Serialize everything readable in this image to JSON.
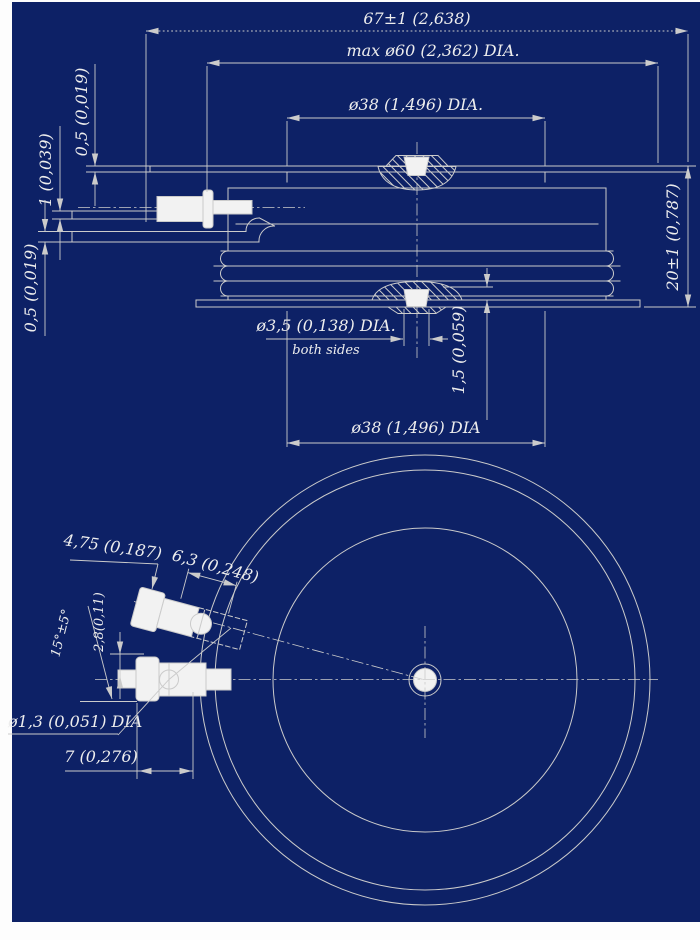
{
  "colors": {
    "background": "#0d2166",
    "line": "#cbcbcb",
    "text": "#ededed",
    "shape_fill": "#f2f2f2"
  },
  "side_view": {
    "overall_width": "67±1 (2,638)",
    "max_body_dia": "max ø60 (2,362) DIA.",
    "top_pole_dia": "ø38 (1,496) DIA.",
    "flange_thickness": "0,5 (0,019)",
    "gate_lead_thickness": "1 (0,039)",
    "cathode_lead_thickness": "0,5 (0,019)",
    "height": "20±1 (0,787)",
    "center_hole_dia": "ø3,5 (0,138) DIA.",
    "center_hole_note": "both sides",
    "pole_boss_height": "1,5 (0,059)",
    "bottom_pole_dia": "ø38 (1,496) DIA"
  },
  "bottom_view": {
    "terminal_end_width": "6,3 (0,248)",
    "terminal_flange_width": "4,75 (0,187)",
    "terminal_angle": "15°±5°",
    "terminal_offset": "2,8(0,11)",
    "terminal_hole_dia": "ø1,3 (0,051) DIA",
    "terminal_length": "7 (0,276)"
  }
}
